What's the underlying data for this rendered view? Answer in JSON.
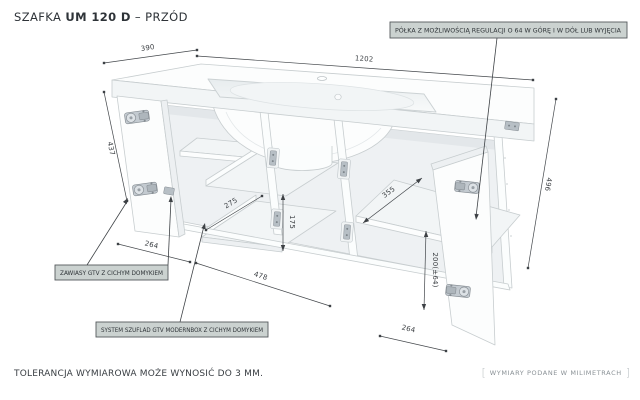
{
  "title": {
    "prefix": "SZAFKA ",
    "model": "UM 120 D",
    "suffix": " – PRZÓD"
  },
  "annotations": {
    "shelf_note": "PÓŁKA Z MOŻLIWOŚCIĄ REGULACJI O 64 W GÓRĘ I W DÓŁ LUB WYJĘCIA",
    "hinges_note": "ZAWIASY GTV Z CICHYM DOMYKIEM",
    "drawers_note": "SYSTEM SZUFLAD GTV MODERNBOX Z CICHYM DOMYKIEM"
  },
  "dimensions": {
    "counter_depth": "390",
    "counter_width": "1202",
    "left_door_height": "437",
    "left_door_width": "264",
    "drawer_depth": "275",
    "drawer_height": "175",
    "drawer_section_width": "478",
    "right_shelf_depth": "355",
    "shelf_position": "200(±64)",
    "right_height": "496",
    "right_door_width": "264"
  },
  "footer": {
    "tolerance_note": "TOLERANCJA WYMIAROWA MOŻE WYNOSIĆ DO 3 MM.",
    "units_note": "WYMIARY PODANE W MILIMETRACH",
    "bracket_left": "[",
    "bracket_right": "]"
  },
  "colors": {
    "background": "#ffffff",
    "furniture_outline": "#c7cdcf",
    "dimension_line": "#43474b",
    "label_box_bg": "#cbd2d0",
    "label_box_border": "#55595c",
    "metal_hardware": "#b7bfc5"
  }
}
